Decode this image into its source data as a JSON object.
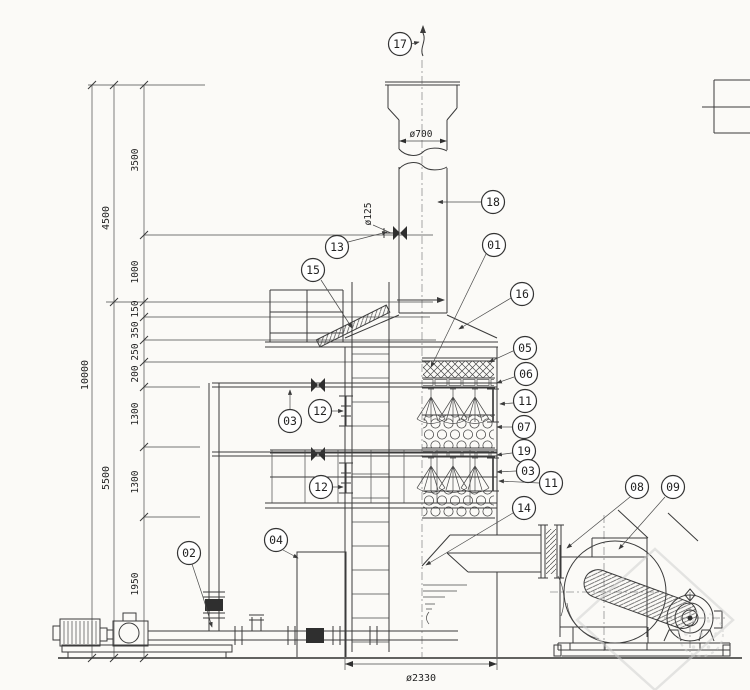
{
  "dimensions": {
    "overall_height": "10000",
    "upper_height": "4500",
    "lower_height": "5500",
    "chain": [
      "3500",
      "1000",
      "150",
      "350",
      "250",
      "200",
      "1300",
      "1300",
      "1950"
    ],
    "stack_diameter": "ø700",
    "drain_pipe_diameter": "ø125",
    "tower_diameter": "ø2330"
  },
  "balloons": {
    "01": "01",
    "02": "02",
    "03": "03",
    "04": "04",
    "05": "05",
    "06": "06",
    "07": "07",
    "08": "08",
    "09": "09",
    "11": "11",
    "12": "12",
    "13": "13",
    "14": "14",
    "15": "15",
    "16": "16",
    "17": "17",
    "18": "18",
    "19": "19"
  },
  "colors": {
    "line": "#3b3b3b",
    "paper": "#fbfaf7",
    "watermark": "#cdcdcd"
  }
}
